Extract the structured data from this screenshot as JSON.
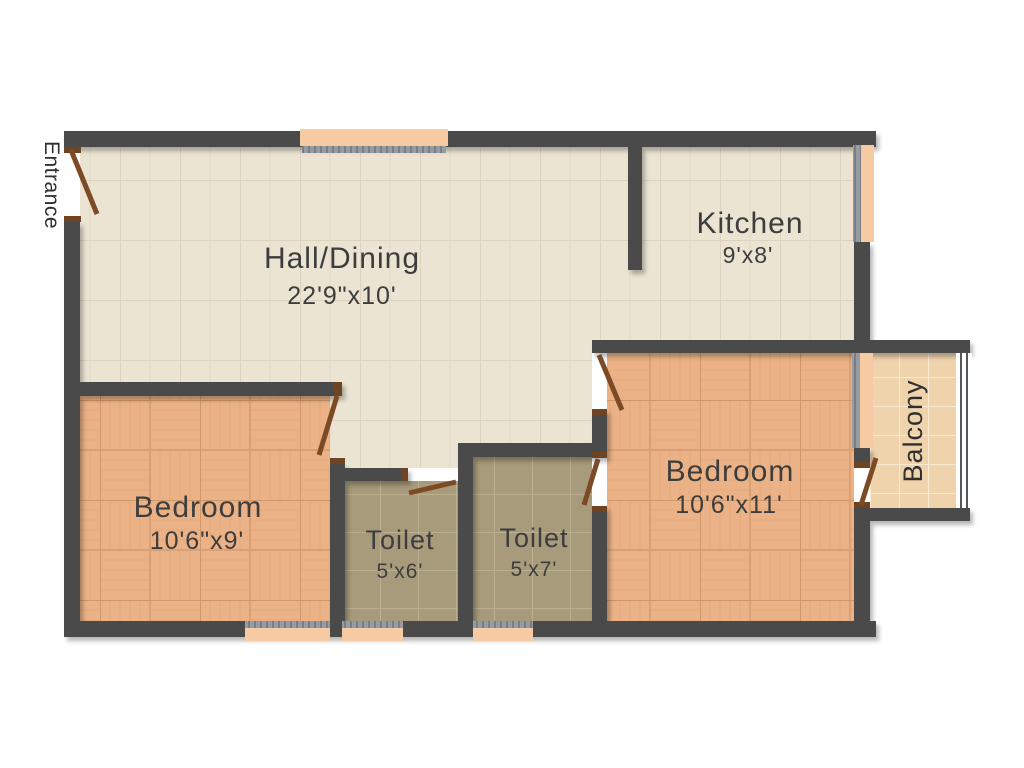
{
  "plan": {
    "entrance_label": "Entrance",
    "rooms": {
      "hall": {
        "name": "Hall/Dining",
        "dims": "22'9\"x10'"
      },
      "kitchen": {
        "name": "Kitchen",
        "dims": "9'x8'"
      },
      "bedroom_right": {
        "name": "Bedroom",
        "dims": "10'6\"x11'"
      },
      "bedroom_left": {
        "name": "Bedroom",
        "dims": "10'6\"x9'"
      },
      "toilet_left": {
        "name": "Toilet",
        "dims": "5'x6'"
      },
      "toilet_right": {
        "name": "Toilet",
        "dims": "5'x7'"
      },
      "balcony": {
        "name": "Balcony"
      }
    },
    "colors": {
      "wall": "#4a4a4a",
      "door_leaf": "#7c4b26",
      "door_jamb": "#6e4423",
      "window_sill": "#f6cba4",
      "window_glazing": "#969ca2",
      "hall_floor": "#ebe4d3",
      "bedroom_floor": "#eab286",
      "toilet_floor": "#a79b7b",
      "balcony_floor": "#efd3ac",
      "label_text": "#3d3d3d"
    }
  }
}
